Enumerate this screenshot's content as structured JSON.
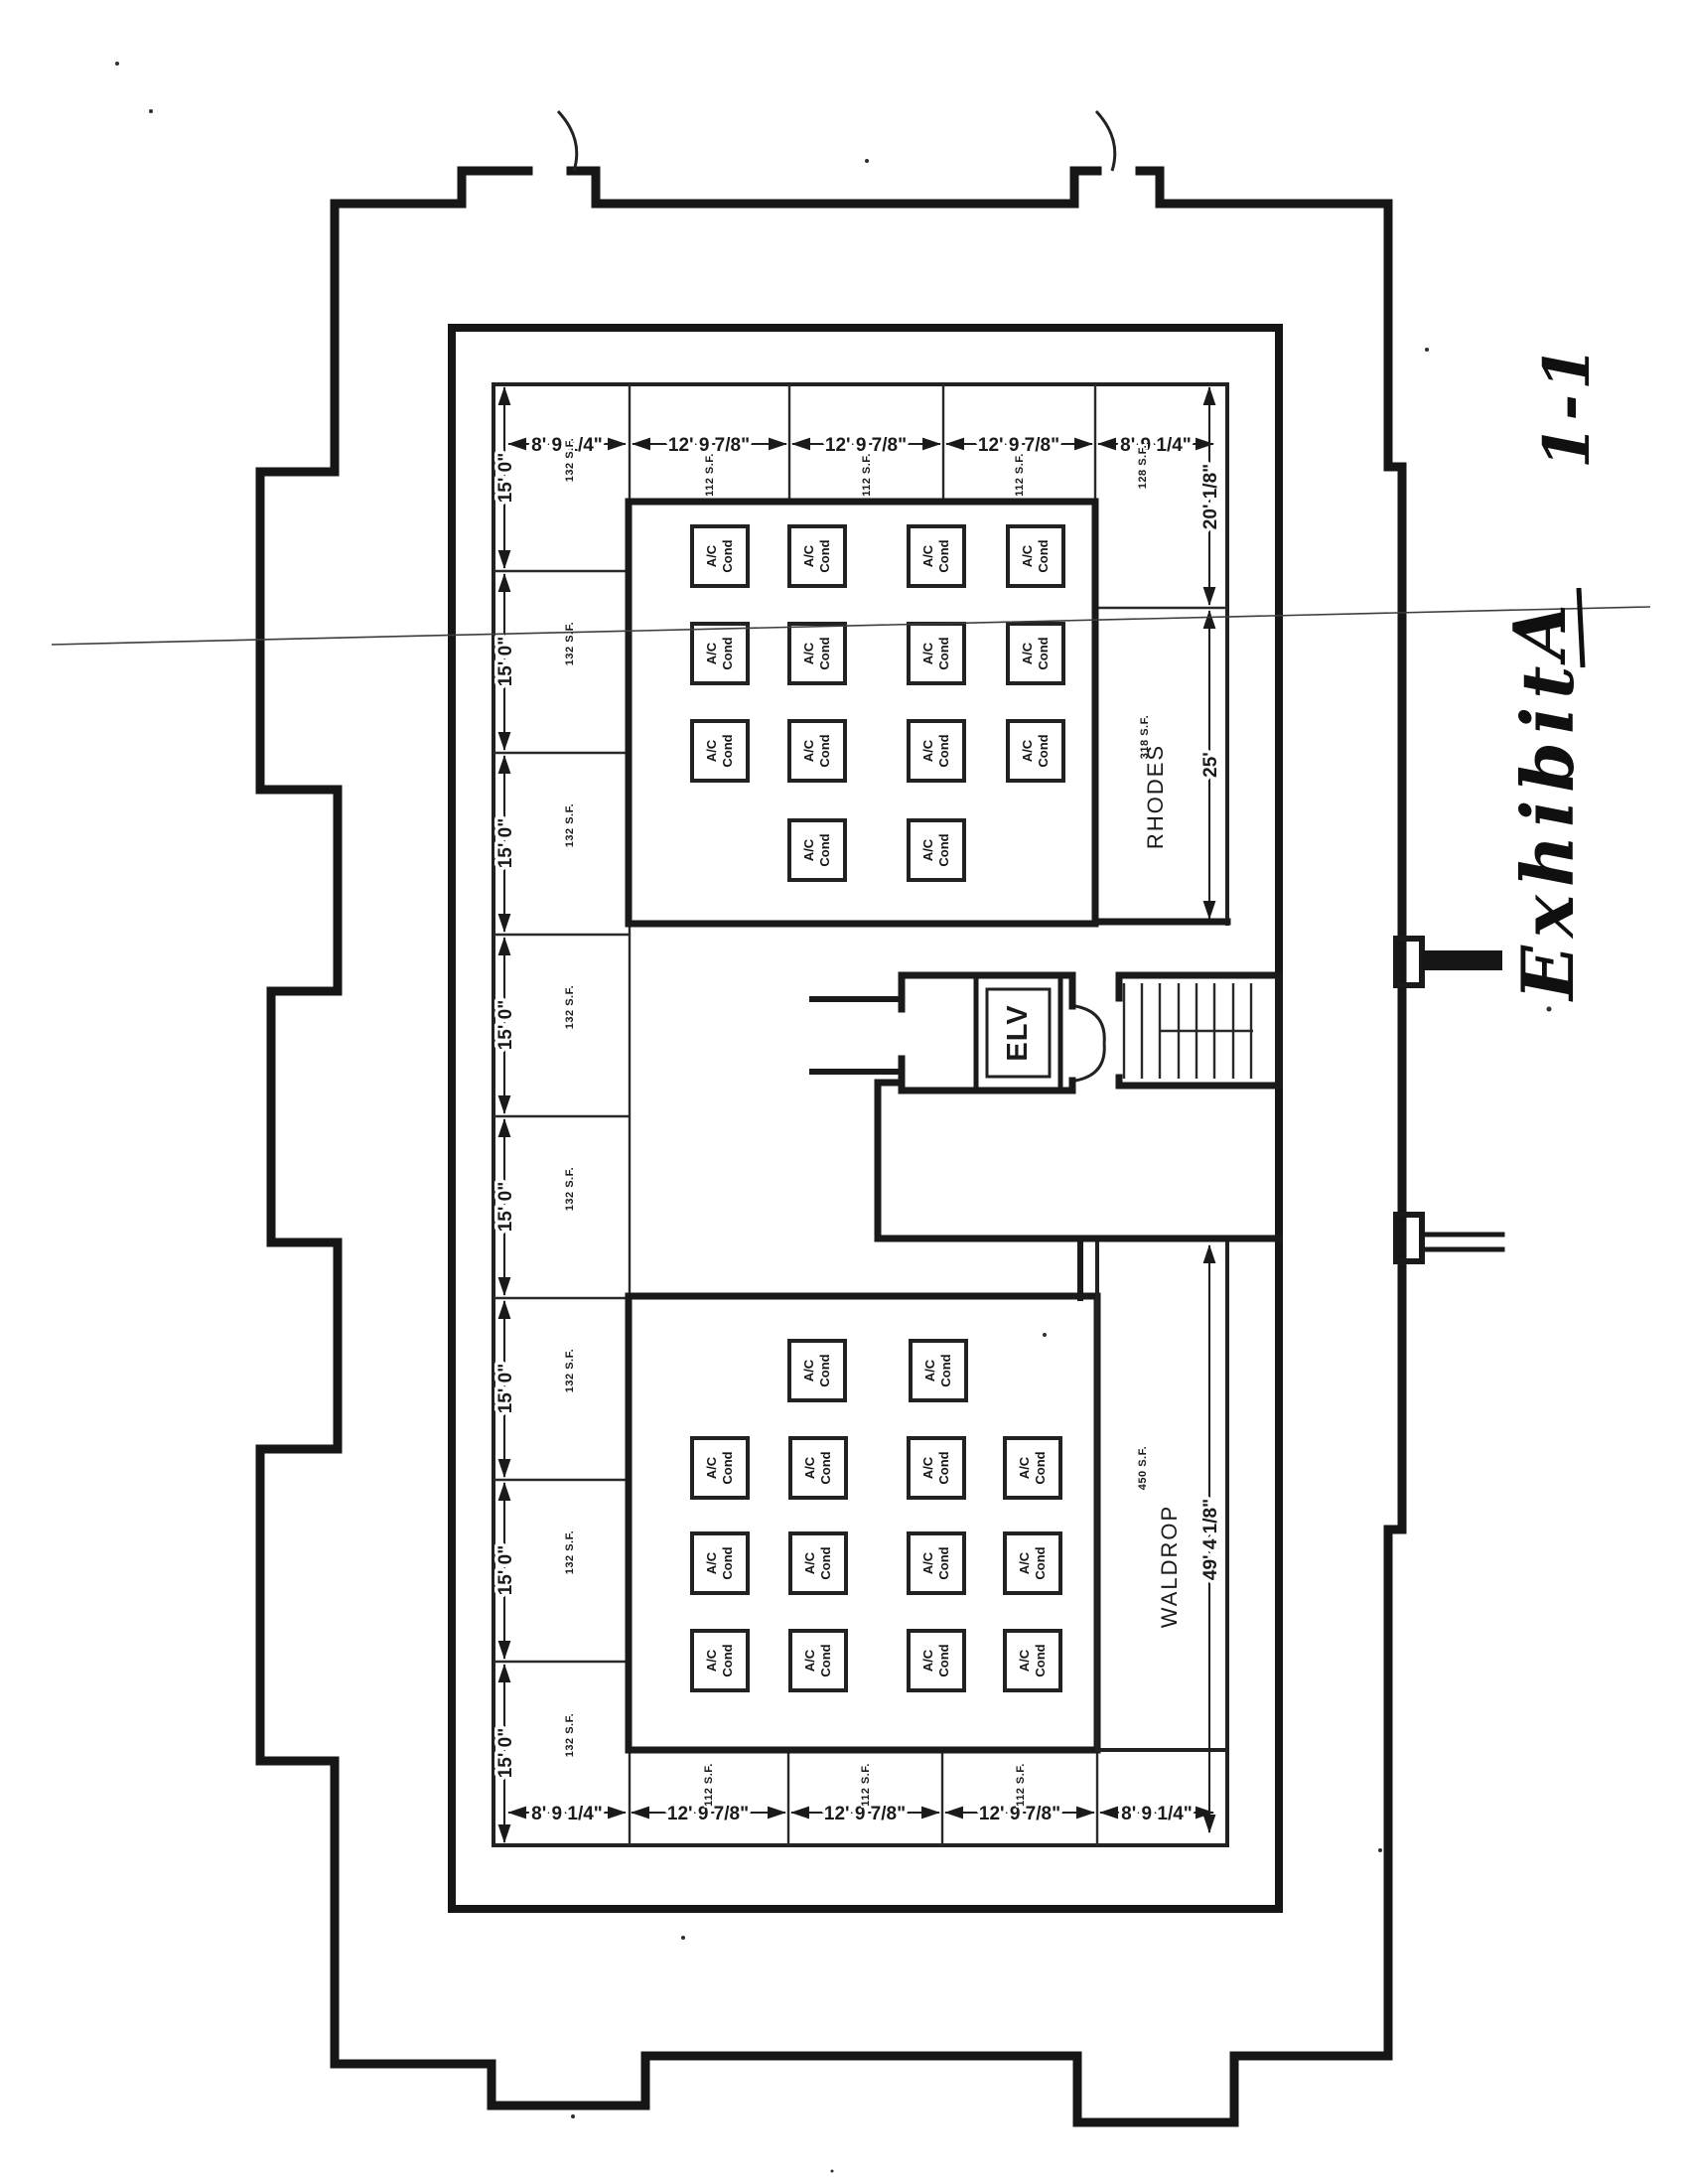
{
  "page": {
    "background": "#ffffff",
    "ink": "#161616"
  },
  "labels": {
    "ac_line1": "A/C",
    "ac_line2": "Cond",
    "elevator": "ELV",
    "room_upper": "RHODES",
    "room_lower": "WALDROP"
  },
  "dimensions": {
    "corner_width": "8' 9 1/4\"",
    "bay_width": "12' 9 7/8\"",
    "cell_height": "15' 0\"",
    "right_top_height": "20' 1/8\"",
    "rhodes_height": "25'",
    "waldrop_height": "49' 4 1/8\""
  },
  "areas": {
    "left_cell": "132 S.F.",
    "bay_cell": "112 S.F.",
    "right_top_cell": "128 S.F.",
    "rhodes_cell": "318 S.F.",
    "waldrop_cell": "450 S.F."
  },
  "annotation": {
    "word": "Exhibit",
    "letter": "A",
    "number": "1-1"
  }
}
